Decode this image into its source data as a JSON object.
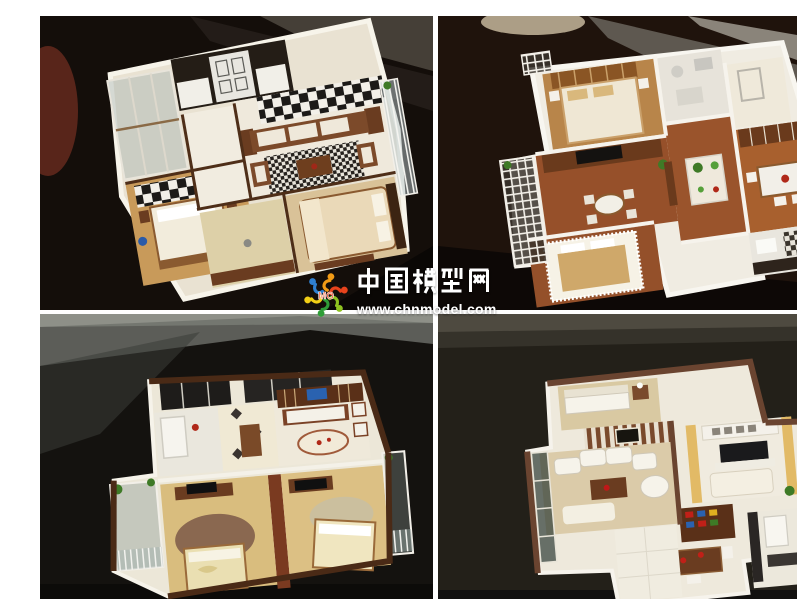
{
  "page": {
    "title": "Architectural scale model photo collage",
    "layout": "2x2 photo grid with white dividers",
    "divider_color": "#ffffff"
  },
  "watermark": {
    "site_name": "中国模型网",
    "url": "www.chnmodel.com",
    "logo_text": "MO",
    "text_color": "#ffffff",
    "logo_colors": [
      "#2f7fd0",
      "#f29b16",
      "#e8431c",
      "#8fc320",
      "#f2cf16",
      "#2f9e38"
    ]
  },
  "photos": [
    {
      "id": "top-left",
      "description": "Apartment interior scale model viewed from above on a dark glass table: white floors, dark-brown furniture, black-and-white checkered feature wall and rug, two bedrooms with beds, glass balconies",
      "background_color": "#140e0a"
    },
    {
      "id": "top-right",
      "description": "Apartment interior scale model with bright white walls and red-brown wood floors: bedroom, bathroom, living room with TV wall, dining room, kitchen with checkered tiles, lattice balcony",
      "background_color": "#1f130c"
    },
    {
      "id": "bottom-left",
      "description": "Apartment interior scale model with maroon wall caps: two front bedrooms with tan carpet, round rugs and beds, rear living room with white sofas, kitchen, side balconies with plants",
      "background_color": "#14120f"
    },
    {
      "id": "bottom-right",
      "description": "Apartment interior scale model: living room with white curved sofa and striped feature wall, yellow TV lounge, dining set with red dishes, kitchen, brown-trimmed glass balconies",
      "background_color": "#232019"
    }
  ]
}
